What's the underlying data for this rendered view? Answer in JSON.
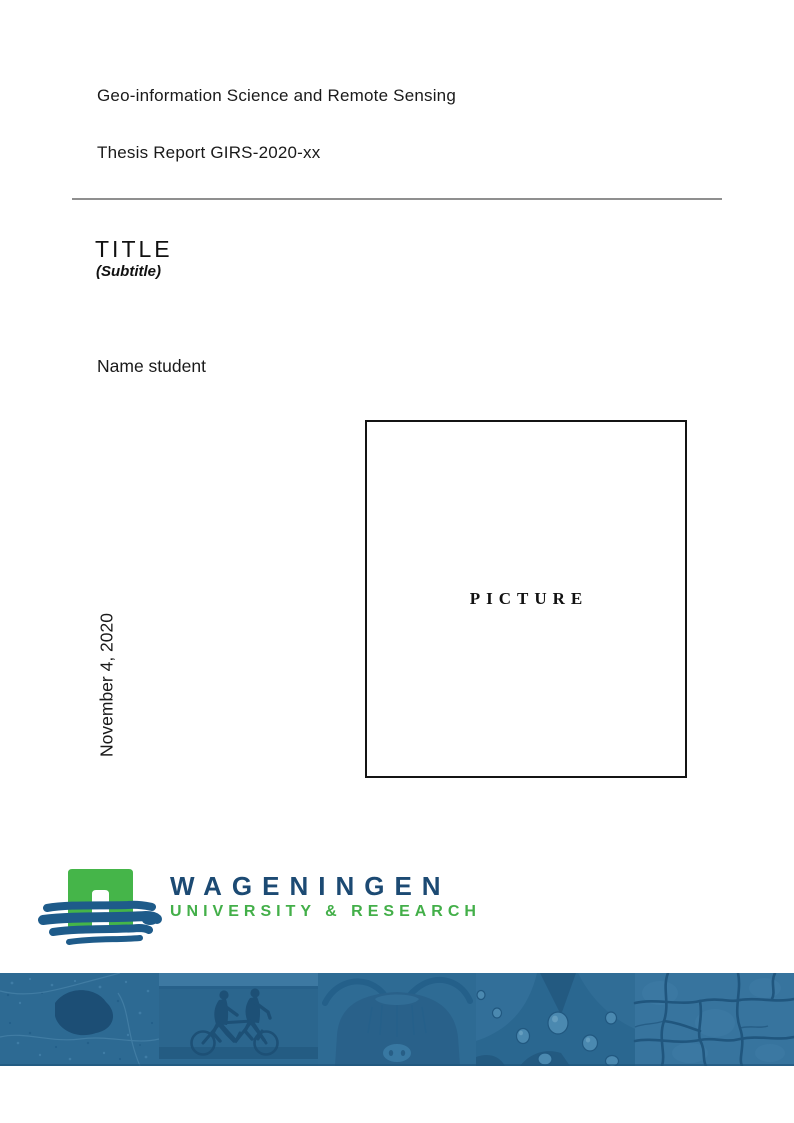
{
  "page": {
    "program": "Geo-information Science and Remote Sensing",
    "report_id": "Thesis Report GIRS-2020-xx",
    "title": "TITLE",
    "subtitle": "(Subtitle)",
    "author": "Name student",
    "picture_placeholder": "PICTURE",
    "date": "November 4, 2020"
  },
  "logo": {
    "wordmark_line1": "WAGENINGEN",
    "wordmark_line2": "UNIVERSITY & RESEARCH",
    "colors": {
      "navy_text": "#1C4A73",
      "green_text": "#43AF49",
      "arch_green": "#45B549",
      "brush_blue": "#1E5B8A"
    }
  },
  "footer": {
    "strip_base_color": "#2E6B94",
    "strip_dark_color": "#1D5076",
    "segments": [
      {
        "name": "aerial-landscape"
      },
      {
        "name": "tandem-cyclists"
      },
      {
        "name": "highland-cow"
      },
      {
        "name": "leaf-droplets"
      },
      {
        "name": "cracked-earth"
      }
    ]
  }
}
